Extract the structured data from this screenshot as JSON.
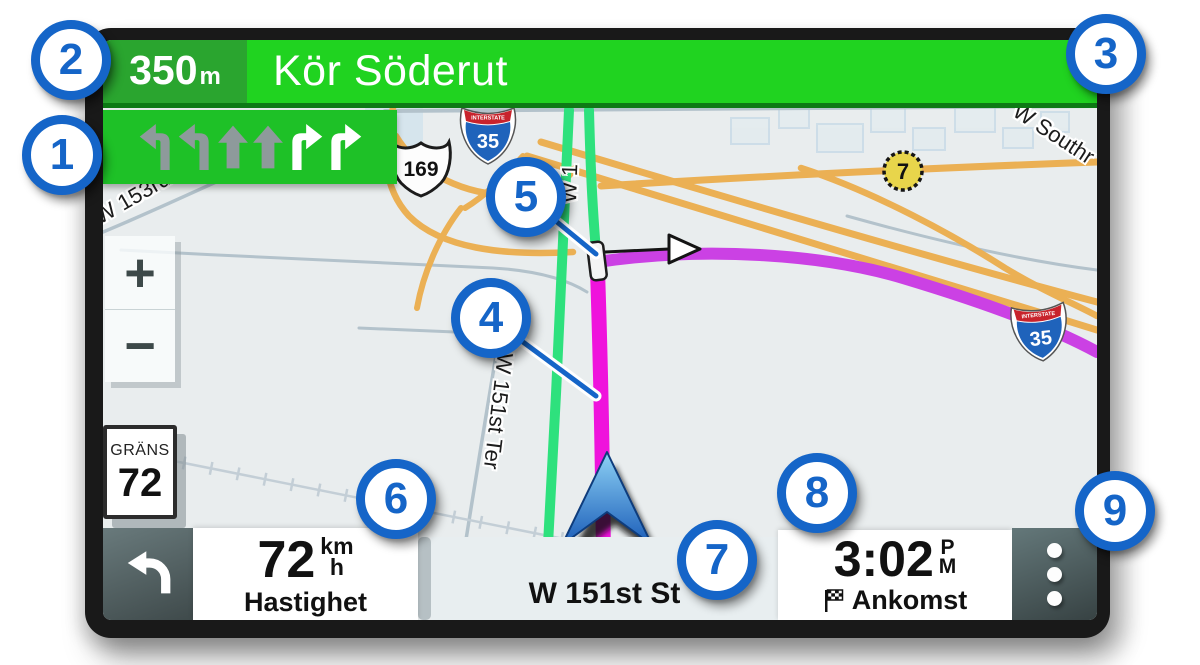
{
  "colors": {
    "banner_green_dark": "#2aa52f",
    "banner_green_bright": "#20d320",
    "lane_box_green": "#1ec127",
    "route_magenta": "#ef13dc",
    "route_purple": "#cb41e4",
    "road_green": "#2ee17d",
    "highway_orange": "#ebb054",
    "callout_blue": "#1565c8",
    "map_background": "#e9edee"
  },
  "banner": {
    "distance_value": "350",
    "distance_unit": "m",
    "instruction": "Kör Söderut"
  },
  "lane_guidance": {
    "arrows": [
      "left-turn",
      "left-turn",
      "straight",
      "straight",
      "right-turn",
      "right-turn"
    ],
    "highlighted": [
      "right-turn",
      "right-turn"
    ]
  },
  "map": {
    "street_labels": {
      "nw": "W 153rd St",
      "mid": "W 151st Ter",
      "top": "W 1",
      "ne": "W Southr"
    },
    "shields": {
      "interstate_banner": "INTERSTATE",
      "interstate_top": "35",
      "interstate_right": "35",
      "us_route": "169",
      "county": "7"
    },
    "speed_limit": {
      "title": "GRÄNS",
      "value": "72"
    },
    "zoom_in_label": "+",
    "zoom_out_label": "−"
  },
  "status_bar": {
    "speed_value": "72",
    "speed_unit_top": "km",
    "speed_unit_bottom": "h",
    "speed_label": "Hastighet",
    "current_street": "W 151st St",
    "arrival_time": "3:02",
    "arrival_meridiem_top": "P",
    "arrival_meridiem_bottom": "M",
    "arrival_label": "Ankomst"
  },
  "callouts": [
    "1",
    "2",
    "3",
    "4",
    "5",
    "6",
    "7",
    "8",
    "9"
  ]
}
